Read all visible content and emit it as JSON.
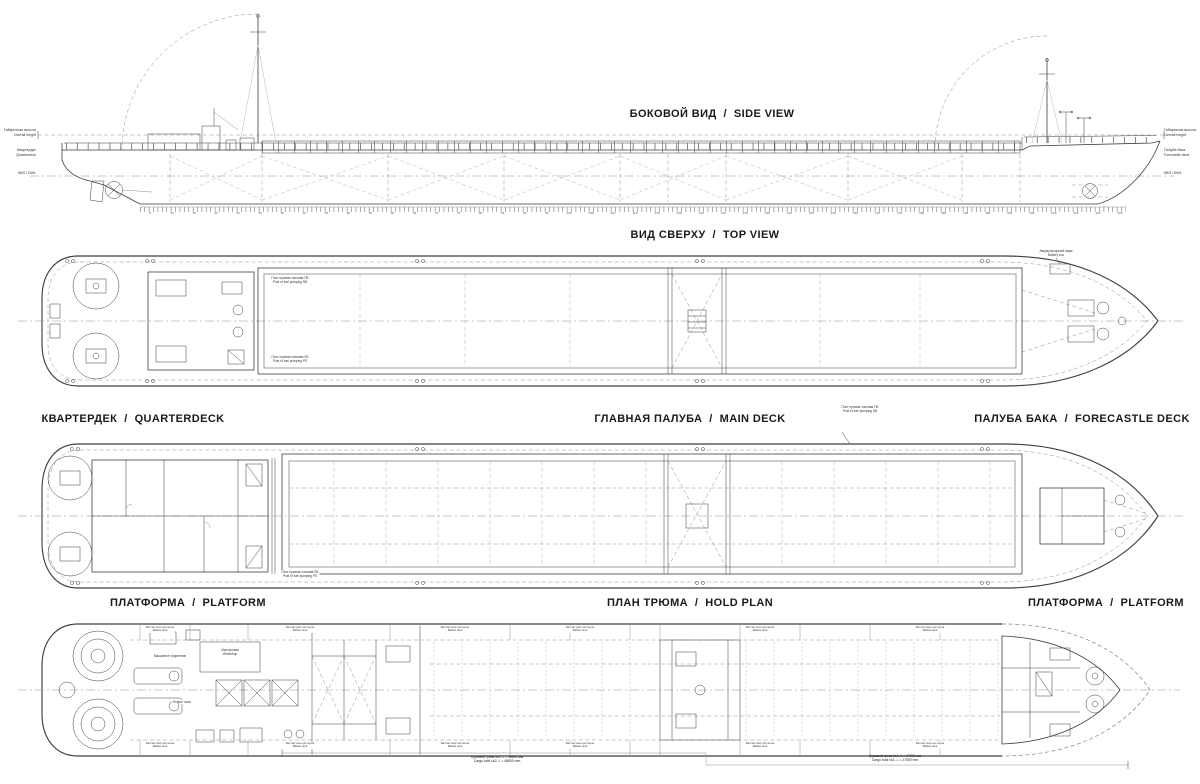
{
  "colors": {
    "background": "#ffffff",
    "line": "#3f3f3f",
    "light_line": "#909090",
    "text": "#1a1a1a"
  },
  "titles": {
    "side_view": "БОКОВОЙ ВИД  /  SIDE VIEW",
    "top_view": "ВИД СВЕРХУ  /  TOP VIEW",
    "quarterdeck": "КВАРТЕРДЕК  /  QUARTERDECK",
    "main_deck": "ГЛАВНАЯ ПАЛУБА  /  MAIN DECK",
    "forecastle_deck": "ПАЛУБА БАКА  /  FORECASTLE DECK",
    "platform_left": "ПЛАТФОРМА  /  PLATFORM",
    "hold_plan": "ПЛАН ТРЮМА  /  HOLD PLAN",
    "platform_right": "ПЛАТФОРМА  /  PLATFORM"
  },
  "side_view": {
    "margin_left": {
      "l1a": "Габаритная высота",
      "l1b": "Overall height",
      "l2a": "Квартердек",
      "l2b": "Quarterdeck",
      "l3": "КВЛ / DWL"
    },
    "margin_right": {
      "r1a": "Габаритная высота",
      "r1b": "Overall height",
      "r2a": "Палуба бака",
      "r2b": "Forecastle deck",
      "r3": "КВЛ / DWL"
    },
    "ruler": {
      "start": 5,
      "end": 225,
      "step": 5
    }
  },
  "top_view": {
    "battery_ru": "Аккумуляторный ящик",
    "battery_en": "Battery box",
    "fuel_sb_ru": "Пост приема топлива ПБ",
    "fuel_sb_en": "Post of fuel pumping SB",
    "fuel_ps_ru": "Пост приема топлива ЛБ",
    "fuel_ps_en": "Post of fuel pumping PS"
  },
  "deck_plan": {
    "fuel_sb_ru": "Пост приема топлива ПБ",
    "fuel_sb_en": "Post of fuel pumping SB",
    "fuel_ps_ru": "Пост приема топлива ЛБ",
    "fuel_ps_en": "Post of fuel pumping PS"
  },
  "hold_plan": {
    "ballast_ru": "Балластная цистерна",
    "ballast_en": "Ballast tank",
    "engine_room_ru": "Машинное отделение",
    "engine_room_en": "Engine room",
    "workshop_ru": "Мастерская",
    "workshop_en": "Workshop",
    "hold2_ru": "Грузовой трюм №2, L = 48800 мм",
    "hold2_en": "Cargo hold №2, L = 48800 mm",
    "hold1_ru": "Грузовой трюм №1, L = 27800 мм",
    "hold1_en": "Cargo hold №1, L = 27800 mm"
  }
}
